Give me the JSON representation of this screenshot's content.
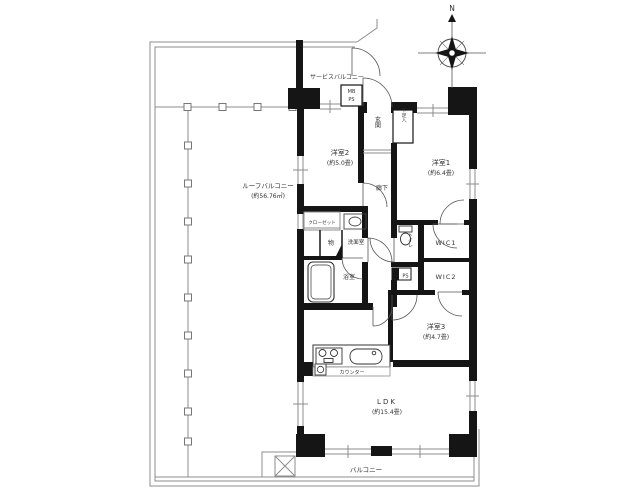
{
  "compass": {
    "north_label": "N"
  },
  "floorplan": {
    "rooms": {
      "service_balcony": {
        "label": "サービスバルコニー"
      },
      "roof_balcony": {
        "label": "ルーフバルコニー",
        "size": "(約56.76㎡)"
      },
      "entrance": {
        "label": "玄関"
      },
      "shoe_cabinet": {
        "label": "下足入"
      },
      "meter_box": {
        "mb": "MB",
        "ps": "PS"
      },
      "room1": {
        "label": "洋室1",
        "size": "(約6.4畳)"
      },
      "room2": {
        "label": "洋室2",
        "size": "(約5.0畳)"
      },
      "room3": {
        "label": "洋室3",
        "size": "(約4.7畳)"
      },
      "corridor": {
        "label": "廊下"
      },
      "closet": {
        "label": "クローゼット"
      },
      "storage": {
        "label": "物"
      },
      "washroom": {
        "label": "洗面室"
      },
      "bathroom": {
        "label": "浴室"
      },
      "toilet": {
        "label": "トイレ"
      },
      "wic1": {
        "label": "WIC1"
      },
      "wic2": {
        "label": "WIC2"
      },
      "ps_shaft": {
        "label": "PS"
      },
      "ldk": {
        "label": "LDK",
        "size": "(約15.4畳)"
      },
      "counter": {
        "label": "カウンター"
      },
      "balcony": {
        "label": "バルコニー"
      }
    },
    "colors": {
      "wall": "#151515",
      "line": "#8c8c8c",
      "text": "#333333"
    }
  }
}
